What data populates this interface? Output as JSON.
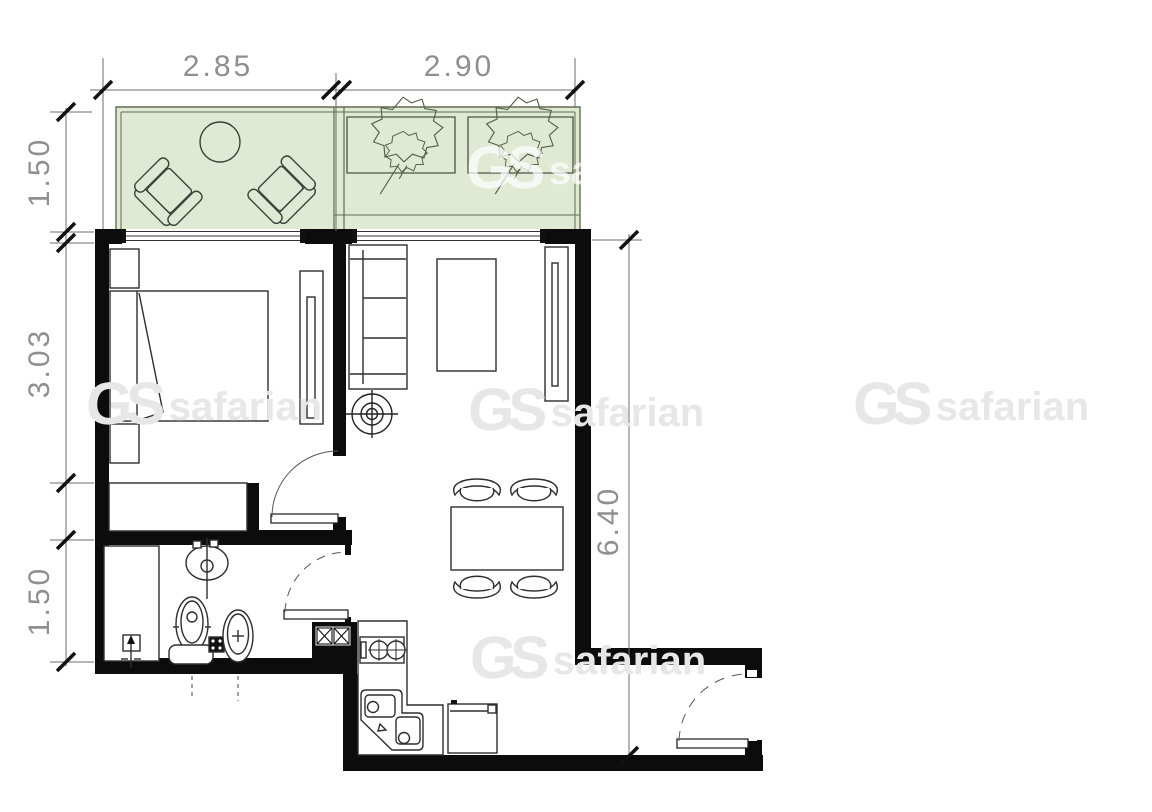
{
  "drawing": {
    "kind": "apartment floor plan"
  },
  "dimensions": {
    "horizontal_top": [
      {
        "label": "2.85"
      },
      {
        "label": "2.90"
      }
    ],
    "vertical_left": [
      {
        "label": "1.50"
      },
      {
        "label": "3.03"
      },
      {
        "label": "1.50"
      }
    ],
    "vertical_right": [
      {
        "label": "6.40"
      }
    ]
  },
  "watermark": {
    "logo": "GS",
    "name": "safarian"
  },
  "colors": {
    "wall": "#0c0c0c",
    "line": "#2e2e2e",
    "dim_line": "#6e6e6e",
    "dim_text": "#8f8f8f",
    "balcony_fill": "#dfe9d3",
    "balcony_line": "#5f6e53",
    "watermark": "#e7e7e7"
  },
  "symbols": [
    "armchair",
    "round-table",
    "planter-with-tree",
    "window",
    "double-bed",
    "nightstand",
    "wardrobe",
    "radiator",
    "sofa",
    "coffee-table",
    "ceiling-fan",
    "dining-table",
    "dining-chair",
    "door-swing",
    "shower-tray",
    "washbasin",
    "toilet",
    "bidet",
    "floor-drain",
    "ventilation-shaft",
    "kitchen-counter",
    "stove",
    "corner-sink",
    "refrigerator"
  ]
}
